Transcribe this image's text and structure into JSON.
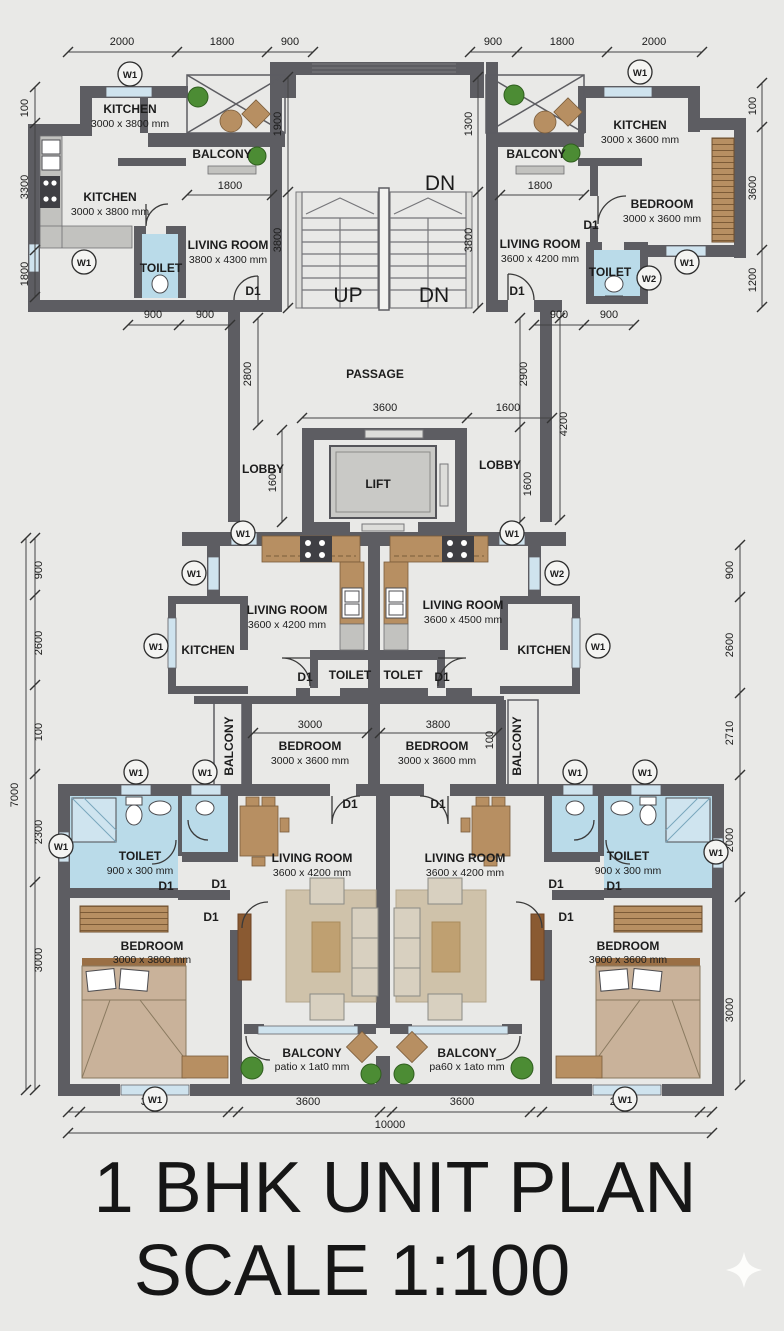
{
  "title": {
    "line1": "1 BHK UNIT PLAN",
    "line2": "SCALE 1:100"
  },
  "colors": {
    "background": "#e9e9e7",
    "wall": "#5d5d62",
    "toilet_fill": "#badbe9",
    "window": "#cfe3ee",
    "wood": "#b78f62",
    "plant": "#4c8c34"
  },
  "marks": {
    "w1": "W1",
    "w2": "W2",
    "d1": "D1"
  },
  "stair": {
    "up": "UP",
    "dn": "DN"
  },
  "core": {
    "passage": "PASSAGE",
    "lift": "LIFT",
    "lobby_left": "LOBBY",
    "lobby_right": "LOBBY"
  },
  "rooms": {
    "top_left": {
      "kitchen_a": "KITCHEN",
      "kitchen_a_size": "3000 x 3800 mm",
      "kitchen_b": "KITCHEN",
      "kitchen_b_size": "3000 x 3800 mm",
      "balcony": "BALCONY",
      "toilet": "TOILET",
      "living": "LIVING ROOM",
      "living_size": "3800 x 4300 mm"
    },
    "top_right": {
      "kitchen": "KITCHEN",
      "kitchen_size": "3000 x 3600 mm",
      "balcony": "BALCONY",
      "toilet": "TOILET",
      "bedroom": "BEDROOM",
      "bedroom_size": "3000 x 3600 mm",
      "living": "LIVING ROOM",
      "living_size": "3600 x 4200 mm"
    },
    "mid_left": {
      "living": "LIVING ROOM",
      "living_size": "3600 x 4200 mm",
      "kitchen": "KITCHEN",
      "toilet": "TOILET",
      "bedroom": "BEDROOM",
      "bedroom_size": "3000 x 3600 mm",
      "balcony": "BALCONY"
    },
    "mid_right": {
      "living": "LIVING ROOM",
      "living_size": "3600 x 4500 mm",
      "kitchen": "KITCHEN",
      "toilet": "TOLET",
      "bedroom": "BEDROOM",
      "bedroom_size": "3000 x 3600 mm",
      "balcony": "BALCONY"
    },
    "bottom_left": {
      "toilet": "TOILET",
      "toilet_size": "900 x 300 mm",
      "bedroom": "BEDROOM",
      "bedroom_size": "3000 x 3800 mm",
      "living": "LIVING ROOM",
      "living_size": "3600 x 4200 mm",
      "balcony": "BALCONY",
      "balcony_size": "patio x 1at0 mm"
    },
    "bottom_right": {
      "toilet": "TOILET",
      "toilet_size": "900 x 300 mm",
      "bedroom": "BEDROOM",
      "bedroom_size": "3000 x 3600 mm",
      "living": "LIVING ROOM",
      "living_size": "3600 x 4200 mm",
      "balcony": "BALCONY",
      "balcony_size": "pa60 x 1ato mm"
    }
  },
  "dims": {
    "top": [
      "2000",
      "1800",
      "900",
      "900",
      "1800",
      "2000"
    ],
    "left_col_top": [
      "100",
      "3300",
      "1800"
    ],
    "right_col_top": [
      "100",
      "3600",
      "1200"
    ],
    "stair": {
      "left_top": "1900",
      "right_top": "1300",
      "left_bot": "3800",
      "right_bot": "3800"
    },
    "balcony_left": "1800",
    "balcony_right": "1800",
    "toilet900": [
      "900",
      "900",
      "900",
      "900"
    ],
    "passage_left": "2800",
    "passage_right": "2900",
    "passage_outer": "4200",
    "lift_width": "3600",
    "lift_side": "1600",
    "lobby_left": "1600",
    "lobby_right": "1600",
    "left_col_mid": [
      "900",
      "2600",
      "100"
    ],
    "left_total": "7000",
    "left_col_bot": [
      "2300",
      "3000"
    ],
    "right_col_mid": [
      "900",
      "2600",
      "2710"
    ],
    "right_col_bot": [
      "2000",
      "3000"
    ],
    "bedroom_left": "3000",
    "bedroom_right": "3800",
    "bedroom_small": "100",
    "bottom": [
      "3000",
      "3600",
      "3600",
      "2000"
    ],
    "bottom_total": "10000"
  }
}
